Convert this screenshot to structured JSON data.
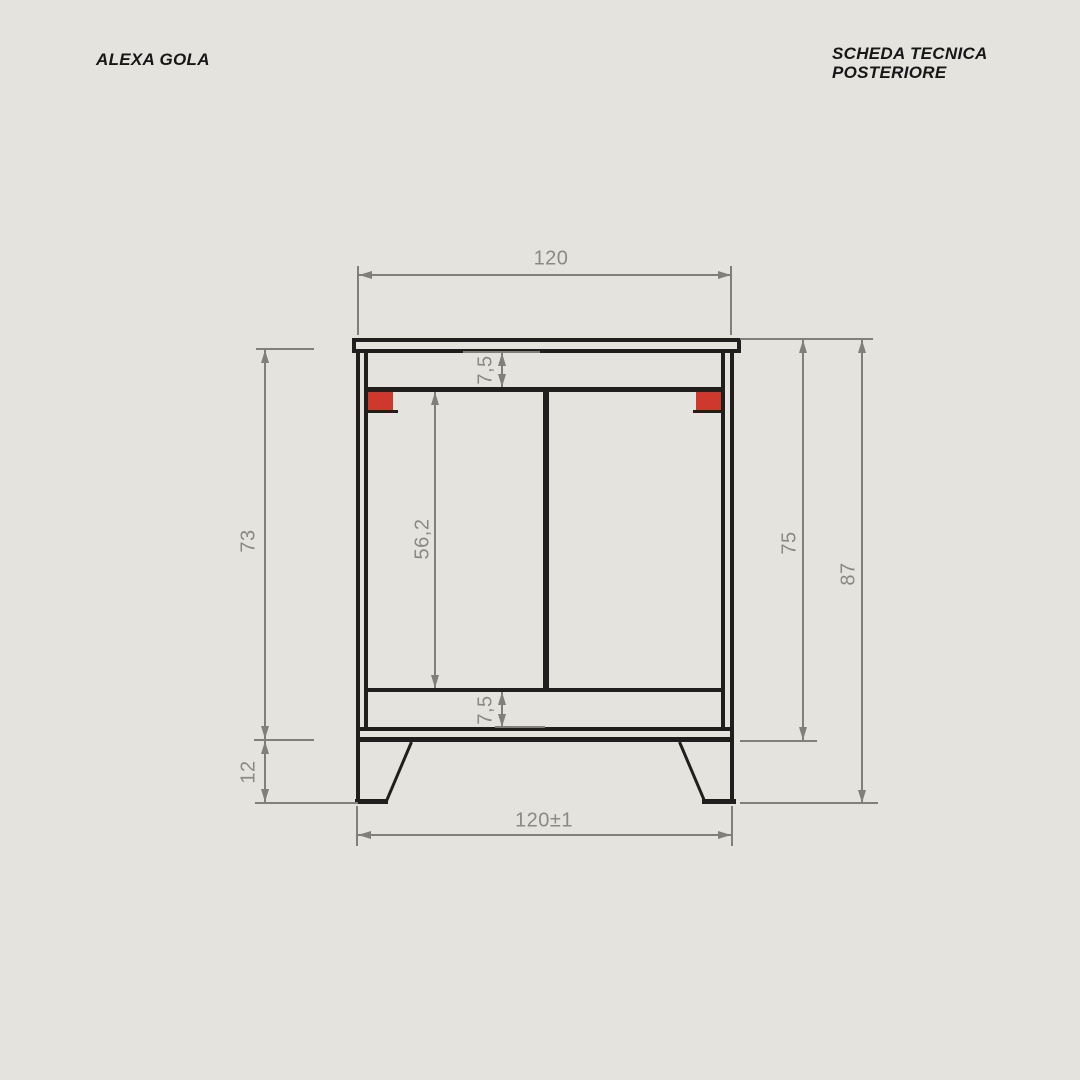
{
  "header": {
    "product_name": "ALEXA GOLA",
    "sheet_title": {
      "line1": "SCHEDA TECNICA",
      "line2": "POSTERIORE"
    }
  },
  "drawing": {
    "view": "posteriore",
    "dimensions": {
      "top_width": "120",
      "top_rail_offset": "7,5",
      "back_panel_height": "56,2",
      "bottom_rail_offset": "7,5",
      "carcass_height": "73",
      "leg_height": "12",
      "body_with_top_height": "75",
      "overall_height": "87",
      "overall_width_tolerance": "120±1"
    },
    "colors": {
      "background": "#e4e3de",
      "line": "#201f1d",
      "dimension": "#807f7a",
      "accent_red": "#cf382d"
    }
  }
}
